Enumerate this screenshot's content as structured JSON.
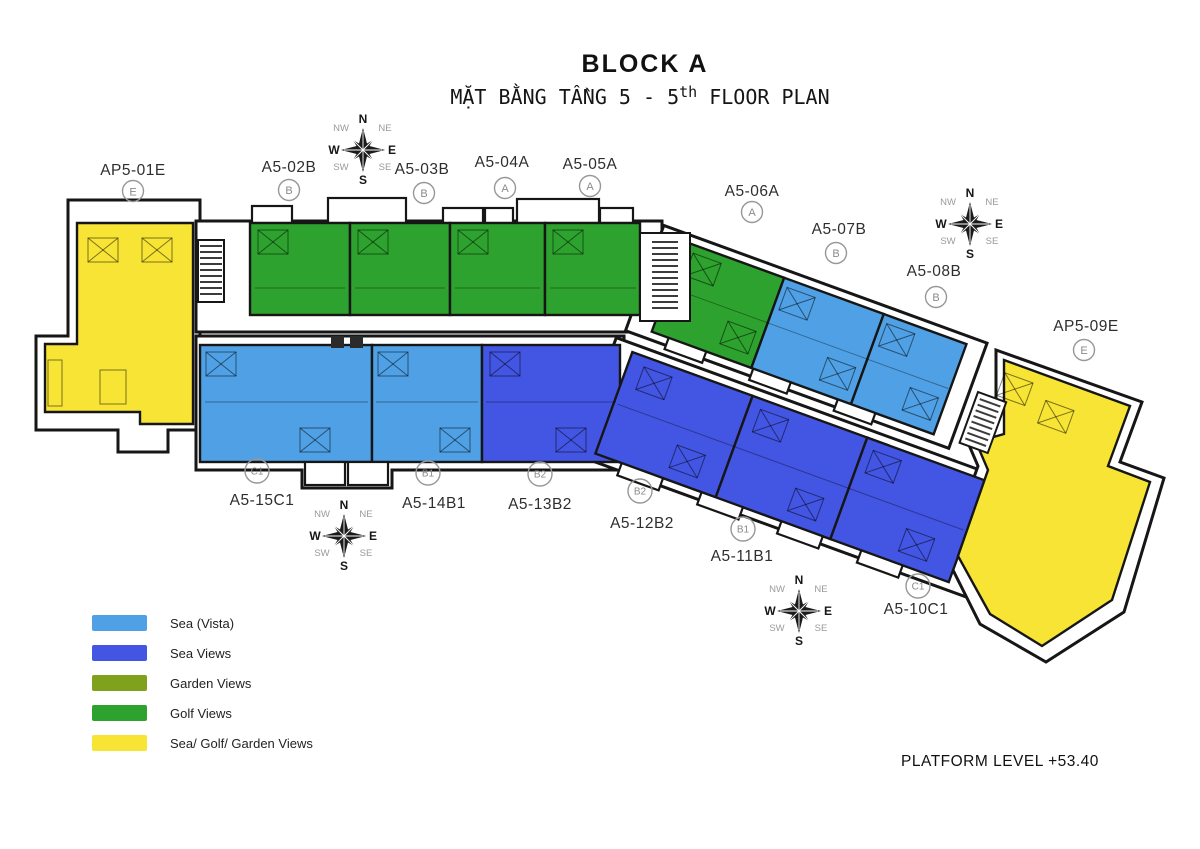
{
  "title": "BLOCK A",
  "subtitle": {
    "prefix": "MẶT BẰNG TẦNG 5 - 5",
    "sup": "th",
    "suffix": " FLOOR PLAN"
  },
  "platform_note": "PLATFORM LEVEL +53.40",
  "compass": {
    "n": "N",
    "s": "S",
    "e": "E",
    "w": "W",
    "ne": "NE",
    "nw": "NW",
    "se": "SE",
    "sw": "SW"
  },
  "colors": {
    "sea_vista": "#4FA0E4",
    "sea_views": "#4355E3",
    "garden_views": "#80A11B",
    "golf_views": "#2EA22E",
    "sea_golf_garden": "#F7E435",
    "outline": "#161616"
  },
  "legend": [
    {
      "label": "Sea (Vista)",
      "color": "#4FA0E4"
    },
    {
      "label": "Sea Views",
      "color": "#4355E3"
    },
    {
      "label": "Garden Views",
      "color": "#80A11B"
    },
    {
      "label": "Golf Views",
      "color": "#2EA22E"
    },
    {
      "label": "Sea/ Golf/ Garden Views",
      "color": "#F7E435"
    }
  ],
  "units": [
    {
      "label": "AP5-01E",
      "type": "E",
      "view": "Sea/ Golf/ Garden Views",
      "color": "#F7E435"
    },
    {
      "label": "A5-02B",
      "type": "B",
      "view": "Golf Views",
      "color": "#2EA22E"
    },
    {
      "label": "A5-03B",
      "type": "B",
      "view": "Golf Views",
      "color": "#2EA22E"
    },
    {
      "label": "A5-04A",
      "type": "A",
      "view": "Golf Views",
      "color": "#2EA22E"
    },
    {
      "label": "A5-05A",
      "type": "A",
      "view": "Golf Views",
      "color": "#2EA22E"
    },
    {
      "label": "A5-06A",
      "type": "A",
      "view": "Golf Views",
      "color": "#2EA22E"
    },
    {
      "label": "A5-07B",
      "type": "B",
      "view": "Sea (Vista)",
      "color": "#4FA0E4"
    },
    {
      "label": "A5-08B",
      "type": "B",
      "view": "Sea (Vista)",
      "color": "#4FA0E4"
    },
    {
      "label": "AP5-09E",
      "type": "E",
      "view": "Sea/ Golf/ Garden Views",
      "color": "#F7E435"
    },
    {
      "label": "A5-10C1",
      "type": "C1",
      "view": "Sea Views",
      "color": "#4355E3"
    },
    {
      "label": "A5-11B1",
      "type": "B1",
      "view": "Sea Views",
      "color": "#4355E3"
    },
    {
      "label": "A5-12B2",
      "type": "B2",
      "view": "Sea Views",
      "color": "#4355E3"
    },
    {
      "label": "A5-13B2",
      "type": "B2",
      "view": "Sea Views",
      "color": "#4355E3"
    },
    {
      "label": "A5-14B1",
      "type": "B1",
      "view": "Sea (Vista)",
      "color": "#4FA0E4"
    },
    {
      "label": "A5-15C1",
      "type": "C1",
      "view": "Sea (Vista)",
      "color": "#4FA0E4"
    }
  ]
}
